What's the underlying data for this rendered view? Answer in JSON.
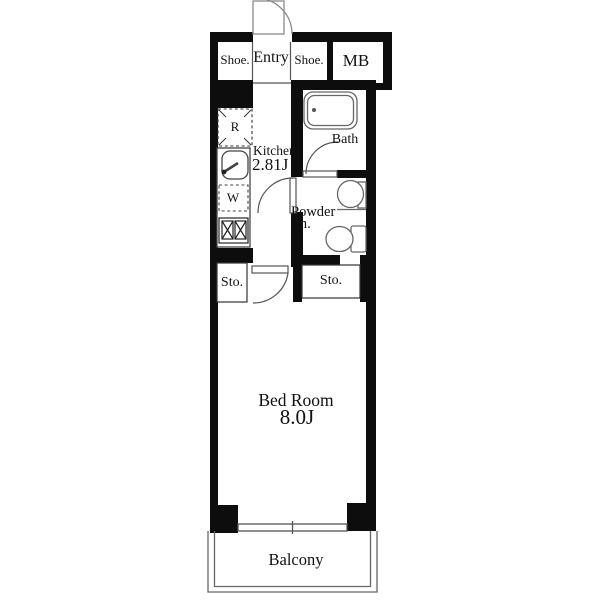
{
  "plan": {
    "entry_area": {
      "shoe_left": "Shoe.",
      "entry": "Entry",
      "shoe_right": "Shoe.",
      "meter_box": "MB"
    },
    "kitchen": {
      "name": "Kitchen",
      "size": "2.81J",
      "fridge": "R",
      "washer": "W"
    },
    "bath": {
      "label": "Bath"
    },
    "powder_room": {
      "line1": "Powder",
      "line2": "rm."
    },
    "storage": {
      "left": "Sto.",
      "right": "Sto."
    },
    "bedroom": {
      "name": "Bed Room",
      "size": "8.0J"
    },
    "balcony": {
      "label": "Balcony"
    },
    "colors": {
      "wall": "#0d0d0d",
      "thin_line": "#555555",
      "fixture_line": "#666666",
      "text": "#111111",
      "background": "#ffffff"
    }
  }
}
